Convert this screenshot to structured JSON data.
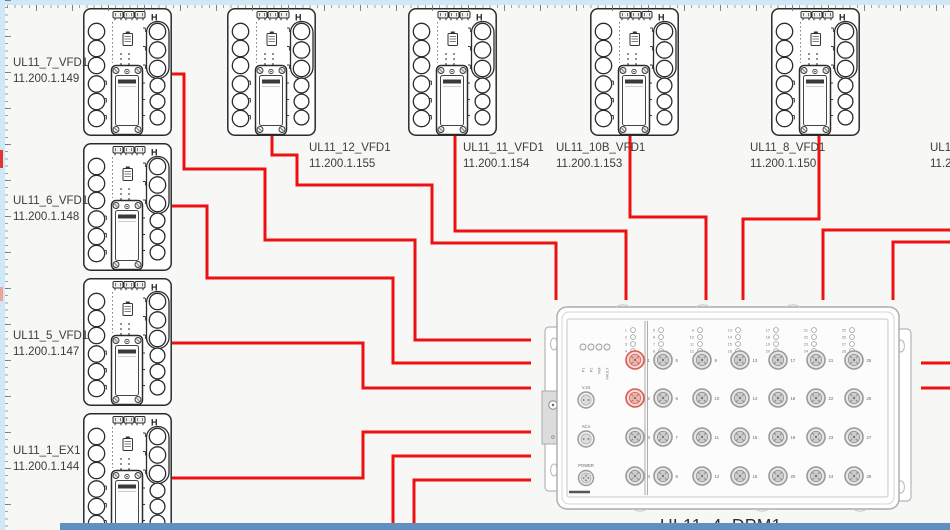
{
  "colors": {
    "cable": "#ee1111",
    "canvas_bg": "#f7f7f6",
    "ruler": "#cfe8f6",
    "bottom_bar": "#5f90bf",
    "device_stroke": "#2b2b2b",
    "dpm_stroke": "#ababab",
    "port_highlight": "#d95b50",
    "label_text": "#3c3c3c"
  },
  "devices": {
    "left": [
      {
        "name": "UL11_7_VFD1",
        "ip": "11.200.1.149",
        "x": 83,
        "y": 8
      },
      {
        "name": "UL11_6_VFD1",
        "ip": "11.200.1.148",
        "x": 83,
        "y": 143
      },
      {
        "name": "UL11_5_VFD1",
        "ip": "11.200.1.147",
        "x": 83,
        "y": 278
      },
      {
        "name": "UL11_1_EX1",
        "ip": "11.200.1.144",
        "x": 83,
        "y": 413
      }
    ],
    "top": [
      {
        "name": "UL11_12_VFD1",
        "ip": "11.200.1.155",
        "x": 227,
        "y": 8
      },
      {
        "name": "UL11_11_VFD1",
        "ip": "11.200.1.154",
        "x": 408,
        "y": 8
      },
      {
        "name": "UL11_10B_VFD1",
        "ip": "11.200.1.153",
        "x": 590,
        "y": 8
      },
      {
        "name": "UL11_8_VFD1",
        "ip": "11.200.1.150",
        "x": 771,
        "y": 8
      }
    ],
    "partial_right": {
      "name": "UL11",
      "ip": "11.2"
    }
  },
  "dpm": {
    "label": "UL11_4_DPM1",
    "x": 557,
    "y": 307,
    "w": 342,
    "h": 202,
    "status_leds": [
      "P1",
      "P2",
      "RM",
      "FAULT"
    ],
    "side_ports": [
      "V.24",
      "ACA",
      "POWER"
    ],
    "port_numbers": [
      1,
      2,
      3,
      4,
      5,
      6,
      7,
      8,
      9,
      10,
      11,
      12,
      13,
      14,
      15,
      16,
      17,
      18,
      19,
      20,
      21,
      22,
      23,
      24,
      25,
      26,
      27,
      28
    ],
    "highlighted_ports": [
      1,
      2
    ],
    "port_cols_x": [
      635,
      663,
      702,
      740,
      778,
      816,
      854
    ],
    "port_rows_y": [
      360,
      398,
      437,
      476
    ]
  },
  "cables": [
    {
      "id": "ul11-7-vfd1",
      "points": [
        [
          172,
          74
        ],
        [
          184,
          74
        ],
        [
          184,
          169
        ],
        [
          265,
          169
        ],
        [
          265,
          240
        ],
        [
          415,
          240
        ],
        [
          415,
          340
        ],
        [
          531,
          340
        ]
      ]
    },
    {
      "id": "ul11-6-vfd1",
      "points": [
        [
          172,
          206
        ],
        [
          207,
          206
        ],
        [
          207,
          278
        ],
        [
          393,
          278
        ],
        [
          393,
          363
        ],
        [
          531,
          363
        ]
      ]
    },
    {
      "id": "ul11-5-vfd1",
      "points": [
        [
          172,
          343
        ],
        [
          363,
          343
        ],
        [
          363,
          388
        ],
        [
          531,
          388
        ]
      ]
    },
    {
      "id": "ul11-1-ex1",
      "points": [
        [
          172,
          478
        ],
        [
          363,
          478
        ],
        [
          363,
          432
        ],
        [
          531,
          432
        ]
      ]
    },
    {
      "id": "from-below-a",
      "points": [
        [
          393,
          532
        ],
        [
          393,
          456
        ],
        [
          531,
          456
        ]
      ]
    },
    {
      "id": "from-below-b",
      "points": [
        [
          414,
          532
        ],
        [
          414,
          480
        ],
        [
          531,
          480
        ]
      ]
    },
    {
      "id": "ul11-12-vfd1",
      "points": [
        [
          272,
          136
        ],
        [
          272,
          155
        ],
        [
          297,
          155
        ],
        [
          297,
          185
        ],
        [
          432,
          185
        ],
        [
          432,
          243
        ],
        [
          556,
          243
        ],
        [
          556,
          300
        ]
      ]
    },
    {
      "id": "ul11-11-vfd1",
      "points": [
        [
          455,
          136
        ],
        [
          455,
          231
        ],
        [
          626,
          231
        ],
        [
          626,
          300
        ]
      ]
    },
    {
      "id": "ul11-10b-vfd1",
      "points": [
        [
          630,
          136
        ],
        [
          630,
          217
        ],
        [
          706,
          217
        ],
        [
          706,
          300
        ]
      ]
    },
    {
      "id": "ul11-8-vfd1",
      "points": [
        [
          819,
          136
        ],
        [
          819,
          219
        ],
        [
          743,
          219
        ],
        [
          743,
          300
        ]
      ]
    },
    {
      "id": "from-right-a",
      "points": [
        [
          952,
          230
        ],
        [
          823,
          230
        ],
        [
          823,
          300
        ]
      ]
    },
    {
      "id": "from-right-b",
      "points": [
        [
          952,
          242
        ],
        [
          893,
          242
        ],
        [
          893,
          300
        ]
      ]
    },
    {
      "id": "dpm-right-stub-a",
      "points": [
        [
          921,
          363
        ],
        [
          952,
          363
        ]
      ]
    },
    {
      "id": "dpm-right-stub-b",
      "points": [
        [
          921,
          388
        ],
        [
          952,
          388
        ]
      ]
    }
  ]
}
